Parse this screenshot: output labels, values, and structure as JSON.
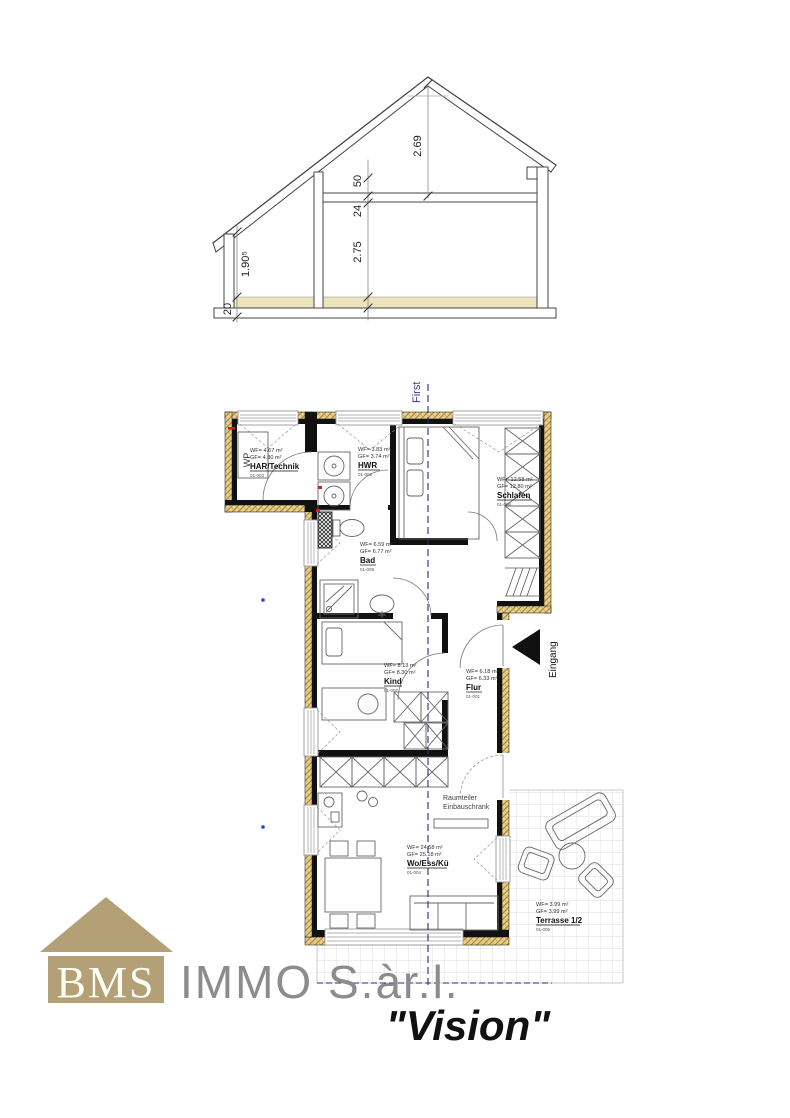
{
  "section": {
    "dim_ridge": "2.69",
    "dim_purlin": "50",
    "dim_beam": "24",
    "dim_room_height": "2.75",
    "dim_knee_wall": "1.90⁵",
    "dim_floor": "20"
  },
  "plan": {
    "ridge_label": "First",
    "entrance_label": "Eingang",
    "divider_label_line1": "Raumteiler",
    "divider_label_line2": "Einbauschrank",
    "heat_pump_label": "WP",
    "rooms": [
      {
        "name": "HAR/Technik",
        "wf": "WF= 4.67 m²",
        "gf": "GF= 4.80 m²",
        "nr": "01-003"
      },
      {
        "name": "HWR",
        "wf": "WF= 3.83 m²",
        "gf": "GF= 3.74 m²",
        "nr": "01-002"
      },
      {
        "name": "Schlafen",
        "wf": "WF= 12.58 m²",
        "gf": "GF= 12.80 m²",
        "nr": "01-006"
      },
      {
        "name": "Bad",
        "wf": "WF= 6.59 m²",
        "gf": "GF= 6.77 m²",
        "nr": "01-008"
      },
      {
        "name": "Kind",
        "wf": "WF= 8.13 m²",
        "gf": "GF= 8.30 m²",
        "nr": "01-007"
      },
      {
        "name": "Flur",
        "wf": "WF= 6.18 m²",
        "gf": "GF= 6.33 m²",
        "nr": "01-001"
      },
      {
        "name": "Wo/Ess/Kü",
        "wf": "WF= 24.58 m²",
        "gf": "GF= 25.18 m²",
        "nr": "01-004"
      },
      {
        "name": "Terrasse 1/2",
        "wf": "WF= 3.99 m²",
        "gf": "GF= 3.99 m²",
        "nr": "01-005"
      }
    ],
    "colors": {
      "insulation": "#e8d293",
      "wall": "#111111",
      "ridge_line": "#2a2a7a",
      "logo_tan": "#b3a077"
    }
  },
  "footer": {
    "brand": "BMS",
    "company": "IMMO S.àr.l.",
    "tagline": "\"Vision\""
  }
}
